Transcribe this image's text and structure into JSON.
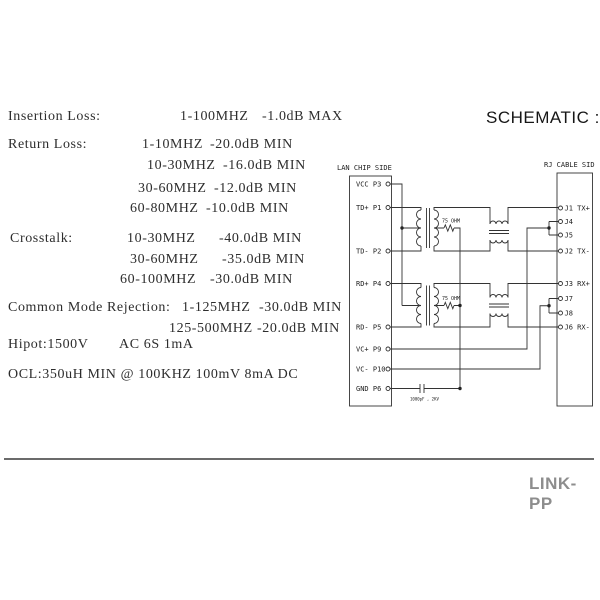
{
  "header": {
    "title": "SCHEMATIC :"
  },
  "specs": {
    "insertion_loss": {
      "label": "Insertion Loss:",
      "rows": [
        {
          "freq": "1-100MHZ",
          "value": "-1.0dB MAX"
        }
      ]
    },
    "return_loss": {
      "label": "Return Loss:",
      "rows": [
        {
          "freq": "1-10MHZ",
          "value": "-20.0dB MIN"
        },
        {
          "freq": "10-30MHZ",
          "value": "-16.0dB MIN"
        },
        {
          "freq": "30-60MHZ",
          "value": "-12.0dB MIN"
        },
        {
          "freq": "60-80MHZ",
          "value": "-10.0dB MIN"
        }
      ]
    },
    "crosstalk": {
      "label": "Crosstalk:",
      "rows": [
        {
          "freq": "10-30MHZ",
          "value": "-40.0dB MIN"
        },
        {
          "freq": "30-60MHZ",
          "value": "-35.0dB MIN"
        },
        {
          "freq": "60-100MHZ",
          "value": "-30.0dB MIN"
        }
      ]
    },
    "common_mode_rejection": {
      "label": "Common Mode Rejection:",
      "rows": [
        {
          "freq": "1-125MHZ",
          "value": "-30.0dB MIN"
        },
        {
          "freq": "125-500MHZ",
          "value": "-20.0dB MIN"
        }
      ]
    },
    "hipot": {
      "label": "Hipot:1500V",
      "value": "AC 6S 1mA"
    },
    "ocl": {
      "label": "OCL:350uH MIN @ 100KHZ 100mV 8mA DC"
    }
  },
  "schematic": {
    "left_header": "LAN CHIP SIDE",
    "right_header": "RJ CABLE SID",
    "left_pins": [
      "VCC P3",
      "TD+ P1",
      "TD- P2",
      "RD+ P4",
      "RD- P5",
      "VC+ P9",
      "VC- P10",
      "GND P6"
    ],
    "right_pins": [
      "J1 TX+",
      "J4",
      "J5",
      "J2 TX-",
      "J3 RX+",
      "J7",
      "J8",
      "J6 RX-"
    ],
    "resistor_label": "75 OHM",
    "capacitor_label": "1000pF , 2KV"
  },
  "footer": {
    "brand": "LINK-PP"
  },
  "colors": {
    "ink": "#2d2d2d",
    "schematic_line": "#333333",
    "divider_gray": "#6b6b6b",
    "brand_gray": "#8d8d8d"
  }
}
